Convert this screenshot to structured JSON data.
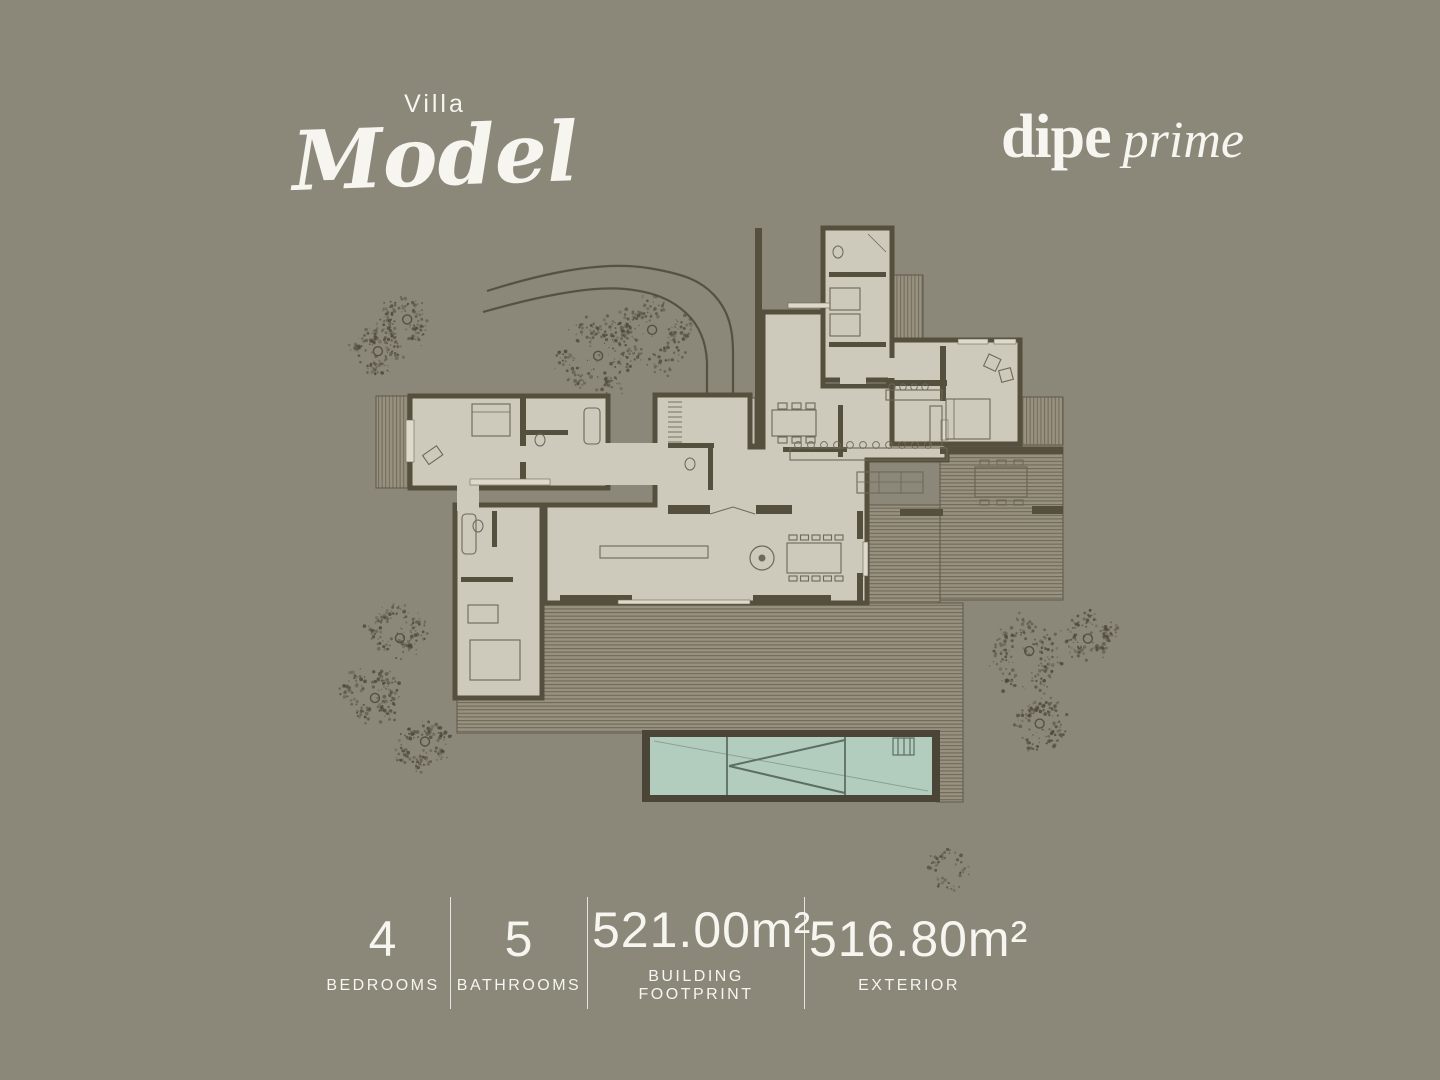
{
  "header": {
    "pretitle": "Villa",
    "title": "Model"
  },
  "brand": {
    "name": "dipe",
    "tagline": "prime"
  },
  "stats": {
    "items": [
      {
        "value": "4",
        "label": "BEDROOMS"
      },
      {
        "value": "5",
        "label": "BATHROOMS"
      },
      {
        "value": "521.00m²",
        "label": "BUILDING FOOTPRINT"
      },
      {
        "value": "516.80m²",
        "label": "EXTERIOR"
      }
    ]
  },
  "floorplan": {
    "description": "top-view villa floor plan with decks, pool, trees and curved driveway",
    "features": [
      "curved-driveway",
      "entry-stairs",
      "kitchen-island",
      "round-fireplace",
      "dining-tables",
      "wood-decks",
      "swimming-pool",
      "trees"
    ]
  },
  "colors": {
    "background": "#8b8779",
    "text": "#f6f5f0",
    "wall": "#554f3d",
    "room": "#cdc9bb",
    "porch": "#c2beae",
    "glass": "#ddd9cb",
    "furniture": "#6e6857",
    "deck": "#97917f",
    "deckLine": "#5f584a",
    "pool": "#b2cdbe",
    "poolFrame": "#4a4536",
    "poolLine": "#5d6f62",
    "tree": "#4d4736",
    "road": "#57513f"
  }
}
